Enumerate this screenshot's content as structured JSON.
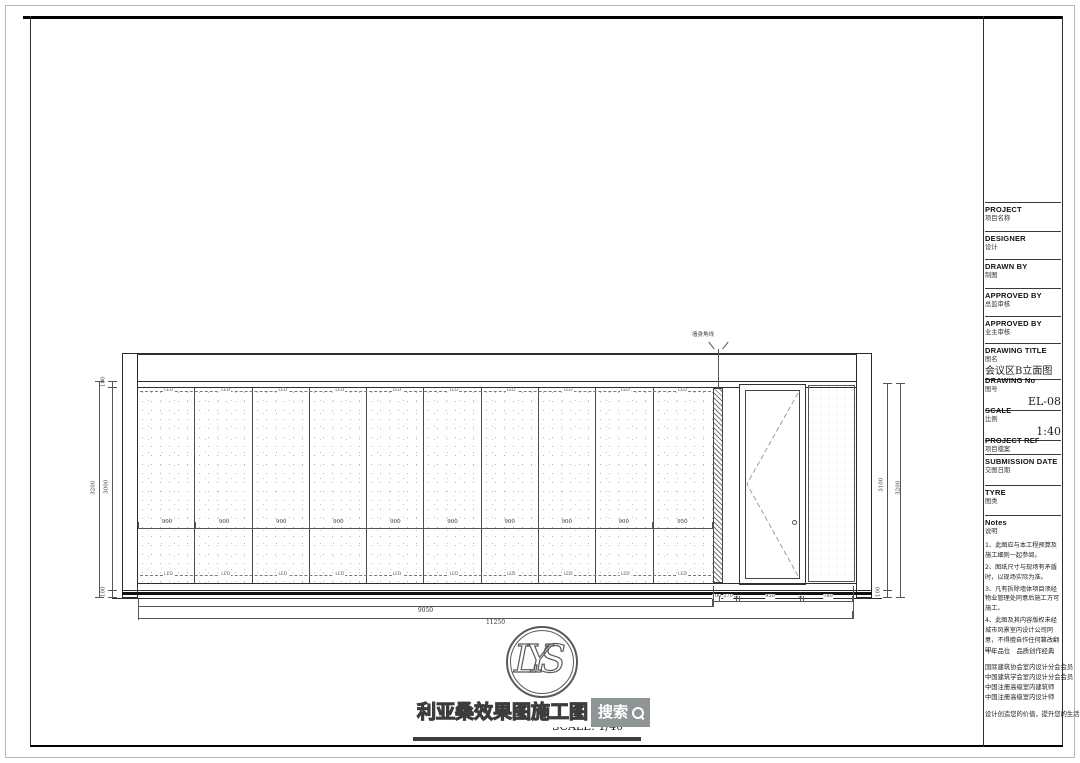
{
  "watermark": {
    "brand_text": "利亚桑效果图施工图",
    "search_label": "搜索"
  },
  "view_title": {
    "text": "会议区B立面图",
    "scale_text": "SCALE: 1/40"
  },
  "logo": {
    "text": "LYS"
  },
  "drawing": {
    "leader_label": "墙身角线",
    "led_label": "LED",
    "panel_dims": [
      "900",
      "900",
      "900",
      "900",
      "900",
      "900",
      "900",
      "900",
      "900",
      "950"
    ],
    "door_area_dims": [
      "100",
      "270",
      "50",
      "950",
      "50",
      "780"
    ],
    "panels_total_dim": "9050",
    "overall_dim": "11250",
    "left_dims": {
      "overall": "3200",
      "top": "100",
      "middle": "3000",
      "bottom": "100"
    },
    "right_dims": {
      "overall": "3200",
      "inner": "3100",
      "bottom": "100"
    }
  },
  "title_block": {
    "project": {
      "en": "PROJECT",
      "zh": "项目名称"
    },
    "designer": {
      "en": "DESIGNER",
      "zh": "设计"
    },
    "drawn_by": {
      "en": "DRAWN BY",
      "zh": "制图"
    },
    "approved_by_1": {
      "en": "APPROVED BY",
      "zh": "总监审核"
    },
    "approved_by_2": {
      "en": "APPROVED BY",
      "zh": "业主审核"
    },
    "drawing_title": {
      "en": "DRAWING TITLE",
      "zh": "图名",
      "value": "会议区B立面图"
    },
    "drawing_no": {
      "en": "DRAWING No",
      "zh": "图号",
      "value": "EL-08"
    },
    "scale": {
      "en": "SCALE",
      "zh": "比例",
      "value": "1:40"
    },
    "project_ref": {
      "en": "PROJECT REF",
      "zh": "项目檔案"
    },
    "submission_date": {
      "en": "SUBMISSION DATE",
      "zh": "交图日期"
    },
    "tyre": {
      "en": "TYRE",
      "zh": "图类"
    },
    "notes": {
      "en": "Notes",
      "zh": "说明",
      "items": [
        "1、此图应与本工程预算及施工细则一起参阅。",
        "2、图纸尺寸与现场有矛盾时，以现场实际为准。",
        "3、凡有拆除墙体项目须经物业管理处同意后施工方可施工。",
        "4、此图及其内容版权未经城市风景室内设计公司同意，不得擅自作任何篡改翻印。"
      ]
    },
    "footer": {
      "slogan1": "十年品位　品质创作经典",
      "certs": [
        "国际建筑协会室内设计分会会员",
        "中国建筑学会室内设计分会会员",
        "中国注册高级室内建筑师",
        "中国注册高级室内设计师"
      ],
      "slogan2": "设计创造您的价值，提升您的生活品质"
    }
  }
}
